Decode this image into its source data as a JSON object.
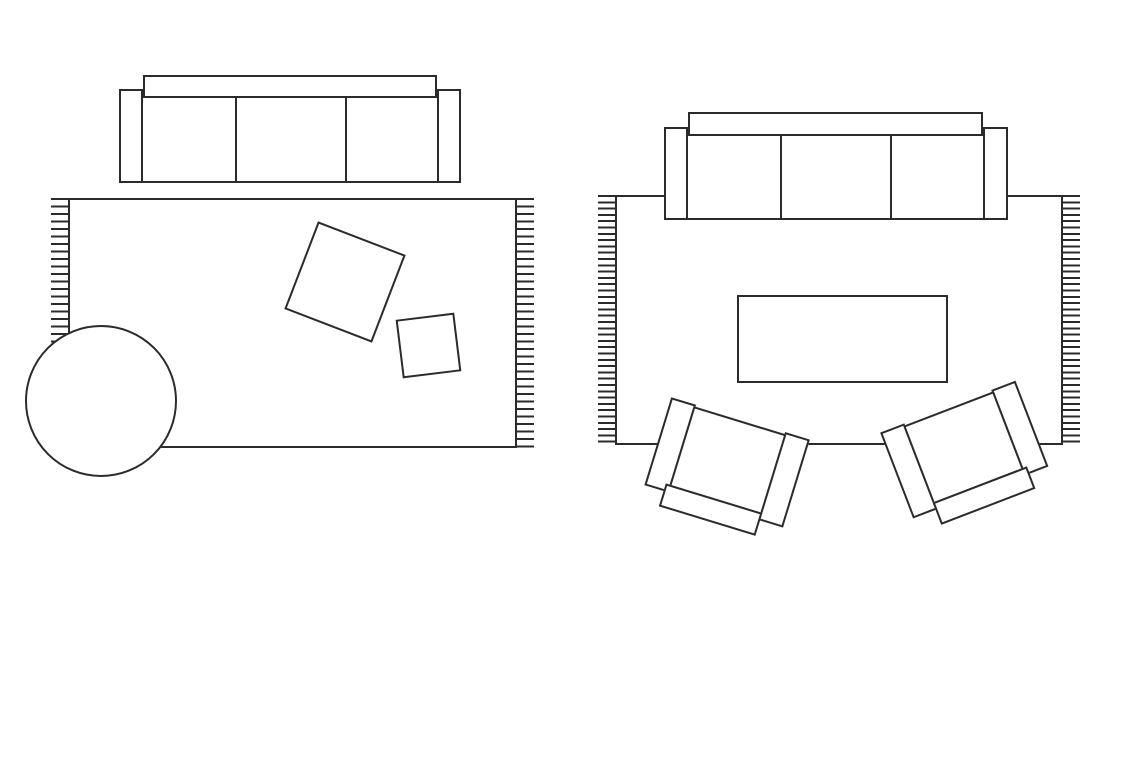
{
  "colors": {
    "background": "#ffffff",
    "stroke": "#2b2b2b",
    "fill": "#ffffff"
  },
  "stroke_width": 2,
  "canvas": {
    "width": 1145,
    "height": 764
  },
  "diagram_type": "furniture-floor-plan-top-view",
  "scene": [
    {
      "id": "rug-layout-left",
      "label": "rug layout with sofa off the rug",
      "items": [
        {
          "id": "left-area-rug",
          "label": "fringed area rug",
          "kind": "rug",
          "x": 68,
          "y": 198,
          "w": 449,
          "h": 250,
          "fringe": {
            "width": 19,
            "spacing": 7.5,
            "sides": [
              "left",
              "right"
            ]
          }
        },
        {
          "id": "left-floor-cushion-large",
          "label": "large square floor cushion",
          "kind": "rect",
          "x": 298,
          "y": 235,
          "w": 94,
          "h": 94,
          "rotate": 21
        },
        {
          "id": "left-floor-cushion-small",
          "label": "small square floor cushion",
          "kind": "rect",
          "x": 399,
          "y": 316,
          "w": 59,
          "h": 59,
          "rotate": -7
        },
        {
          "id": "left-round-side-table",
          "label": "round side table overlapping rug corner",
          "kind": "circle",
          "x": 25,
          "y": 325,
          "w": 152,
          "h": 152
        },
        {
          "id": "left-sofa",
          "label": "three-seat sofa",
          "kind": "composite",
          "x": 119,
          "y": 75,
          "w": 342,
          "h": 108,
          "parts": [
            {
              "name": "left-sofa-backrest",
              "x": 24,
              "y": 0,
              "w": 294,
              "h": 23
            },
            {
              "name": "left-sofa-armrest-left",
              "x": 0,
              "y": 14,
              "w": 24,
              "h": 94
            },
            {
              "name": "left-sofa-armrest-right",
              "x": 318,
              "y": 14,
              "w": 24,
              "h": 94
            },
            {
              "name": "left-sofa-seat-cushions",
              "x": 22,
              "y": 21,
              "w": 298,
              "h": 87,
              "dividers": [
                92,
                202
              ]
            }
          ]
        }
      ]
    },
    {
      "id": "rug-layout-right",
      "label": "rug layout with sofa and chairs on the rug",
      "items": [
        {
          "id": "right-area-rug",
          "label": "fringed area rug",
          "kind": "rug",
          "x": 615,
          "y": 195,
          "w": 448,
          "h": 250,
          "fringe": {
            "width": 19,
            "spacing": 6.3,
            "sides": [
              "left",
              "right"
            ]
          }
        },
        {
          "id": "right-coffee-table",
          "label": "rectangular coffee table",
          "kind": "rect",
          "x": 737,
          "y": 295,
          "w": 211,
          "h": 88
        },
        {
          "id": "right-armchair-left",
          "label": "angled armchair facing upper right",
          "kind": "composite",
          "x": 652,
          "y": 416,
          "w": 145,
          "h": 110,
          "rotate": 17,
          "parts": [
            {
              "name": "armchair-armrest-left",
              "x": 0,
              "y": 0,
              "w": 26,
              "h": 92
            },
            {
              "name": "armchair-armrest-right",
              "x": 119,
              "y": 0,
              "w": 26,
              "h": 92
            },
            {
              "name": "armchair-seat",
              "x": 24,
              "y": 2,
              "w": 97,
              "h": 84
            },
            {
              "name": "armchair-backrest",
              "x": 20,
              "y": 84,
              "w": 101,
              "h": 24
            }
          ]
        },
        {
          "id": "right-armchair-right",
          "label": "angled armchair facing upper left",
          "kind": "composite",
          "x": 895,
          "y": 403,
          "w": 145,
          "h": 110,
          "rotate": -21,
          "mirror": true,
          "parts": [
            {
              "name": "armchair-armrest-left",
              "x": 0,
              "y": 0,
              "w": 26,
              "h": 92
            },
            {
              "name": "armchair-armrest-right",
              "x": 119,
              "y": 0,
              "w": 26,
              "h": 92
            },
            {
              "name": "armchair-seat",
              "x": 24,
              "y": 2,
              "w": 97,
              "h": 84
            },
            {
              "name": "armchair-backrest",
              "x": 20,
              "y": 84,
              "w": 101,
              "h": 24
            }
          ]
        },
        {
          "id": "right-sofa",
          "label": "three-seat sofa with front edge on rug",
          "kind": "composite",
          "x": 664,
          "y": 112,
          "w": 344,
          "h": 108,
          "parts": [
            {
              "name": "right-sofa-backrest",
              "x": 24,
              "y": 0,
              "w": 295,
              "h": 24
            },
            {
              "name": "right-sofa-armrest-left",
              "x": 0,
              "y": 15,
              "w": 24,
              "h": 93
            },
            {
              "name": "right-sofa-armrest-right",
              "x": 319,
              "y": 15,
              "w": 25,
              "h": 93
            },
            {
              "name": "right-sofa-seat-cushions",
              "x": 22,
              "y": 22,
              "w": 299,
              "h": 86,
              "dividers": [
                92,
                202
              ]
            }
          ]
        }
      ]
    }
  ]
}
